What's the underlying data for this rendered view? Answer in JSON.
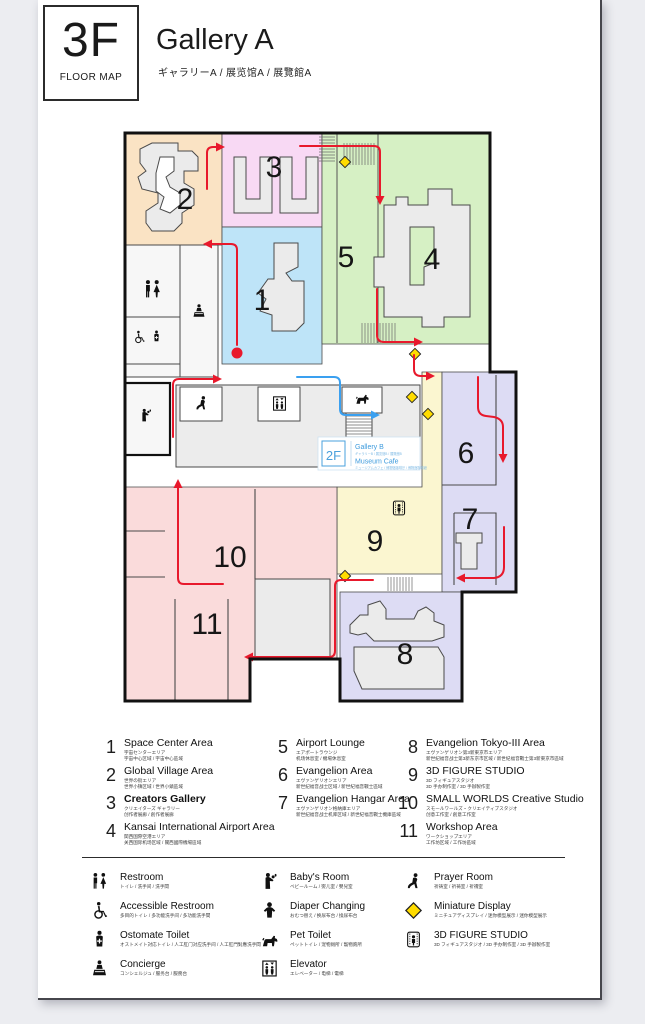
{
  "header": {
    "floor": "3F",
    "floor_caption": "FLOOR MAP",
    "title": "Gallery A",
    "subtitle": "ギャラリーA / 展览馆A / 展覽館A"
  },
  "map": {
    "labels": {
      "a1": "1",
      "a2": "2",
      "a3": "3",
      "a4": "4",
      "a5": "5",
      "a6": "6",
      "a7": "7",
      "a8": "8",
      "a9": "9",
      "a10": "10",
      "a11": "11"
    },
    "sign": {
      "floor": "2F",
      "gallery": "Gallery B",
      "gallery_sub": "ギャラリーB / 展览馆B / 展覽館B",
      "cafe": "Museum Cafe",
      "cafe_sub": "ミュージアムカフェ / 博物馆咖啡厅 / 博物館咖啡廳"
    },
    "colors": {
      "area1_blue": "#BEE4F8",
      "area2_tan": "#FAE3C4",
      "area3_pink": "#F8D9F4",
      "area45_green": "#D6F0C4",
      "area67_lavender": "#DDDCF4",
      "area8_lavender": "#DDDCF4",
      "area9_yellow": "#FBF6D0",
      "area1011_pink": "#FADBDB",
      "route_red": "#E8192C",
      "route_blue": "#3AA0F0",
      "diamond_yellow": "#FFDC00",
      "structure_gray": "#EBEBEB",
      "sign_blue": "#3E9BDD"
    }
  },
  "legend_areas": [
    {
      "num": "1",
      "name": "Space Center Area",
      "sub1": "宇宙センターエリア",
      "sub2": "宇宙中心区域 / 宇宙中心區域"
    },
    {
      "num": "2",
      "name": "Global Village Area",
      "sub1": "世界の街エリア",
      "sub2": "世界小镇区域 / 世界小鎮區域"
    },
    {
      "num": "3",
      "name": "Creators Gallery",
      "sub1": "クリエイターズ ギャラリー",
      "sub2": "创作者展廊 / 創作者展廊"
    },
    {
      "num": "4",
      "name": "Kansai International Airport Area",
      "sub1": "関西国際空港エリア",
      "sub2": "关西国际机场区域 / 關西國際機場區域"
    },
    {
      "num": "5",
      "name": "Airport Lounge",
      "sub1": "エアポートラウンジ",
      "sub2": "机场休息室 / 機場休息室"
    },
    {
      "num": "6",
      "name": "Evangelion Area",
      "sub1": "エヴァンゲリオンエリア",
      "sub2": "新世纪福音战士区域 / 新世紀福音戰士區域"
    },
    {
      "num": "7",
      "name": "Evangelion Hangar Area",
      "sub1": "エヴァンゲリオン格納庫エリア",
      "sub2": "新世纪福音战士机库区域 / 新世紀福音戰士機庫區域"
    },
    {
      "num": "8",
      "name": "Evangelion Tokyo-III Area",
      "sub1": "エヴァンゲリオン第3新東京市エリア",
      "sub2": "新世纪福音战士第3新东京市区域 / 新世紀福音戰士第3新東京市區域"
    },
    {
      "num": "9",
      "name": "3D FIGURE STUDIO",
      "sub1": "3D フィギュアスタジオ",
      "sub2": "3D 手办制作室 / 3D 手辦製作室"
    },
    {
      "num": "10",
      "name": "SMALL WORLDS Creative Studio",
      "sub1": "スモールワールズ・クリエイティブスタジオ",
      "sub2": "创意工作室 / 創意工作室"
    },
    {
      "num": "11",
      "name": "Workshop Area",
      "sub1": "ワークショップエリア",
      "sub2": "工作坊区域 / 工作坊區域"
    }
  ],
  "legend_facilities": [
    {
      "name": "Restroom",
      "sub": "トイレ / 洗手间 / 洗手間"
    },
    {
      "name": "Accessible Restroom",
      "sub": "多目的トイレ / 多功能洗手间 / 多功能洗手間"
    },
    {
      "name": "Ostomate Toilet",
      "sub": "オストメイト対応トイレ / 人工肛门对应洗手间 / 人工肛門對應洗手間"
    },
    {
      "name": "Concierge",
      "sub": "コンシェルジュ / 服务台 / 服務台"
    },
    {
      "name": "Baby's Room",
      "sub": "ベビールーム / 婴儿室 / 嬰兒室"
    },
    {
      "name": "Diaper Changing",
      "sub": "おむつ替え / 换尿布台 / 換尿布台"
    },
    {
      "name": "Pet Toilet",
      "sub": "ペットトイレ / 宠物厕所 / 寵物廁所"
    },
    {
      "name": "Elevator",
      "sub": "エレベーター / 电梯 / 電梯"
    },
    {
      "name": "Prayer Room",
      "sub": "祈祷室 / 祈祷室 / 祈禱室"
    },
    {
      "name": "Miniature Display",
      "sub": "ミニチュアディスプレイ / 迷你模型展示 / 迷你模型展示"
    },
    {
      "name": "3D FIGURE STUDIO",
      "sub": "3D フィギュアスタジオ / 3D 手办制作室 / 3D 手辦製作室"
    }
  ]
}
